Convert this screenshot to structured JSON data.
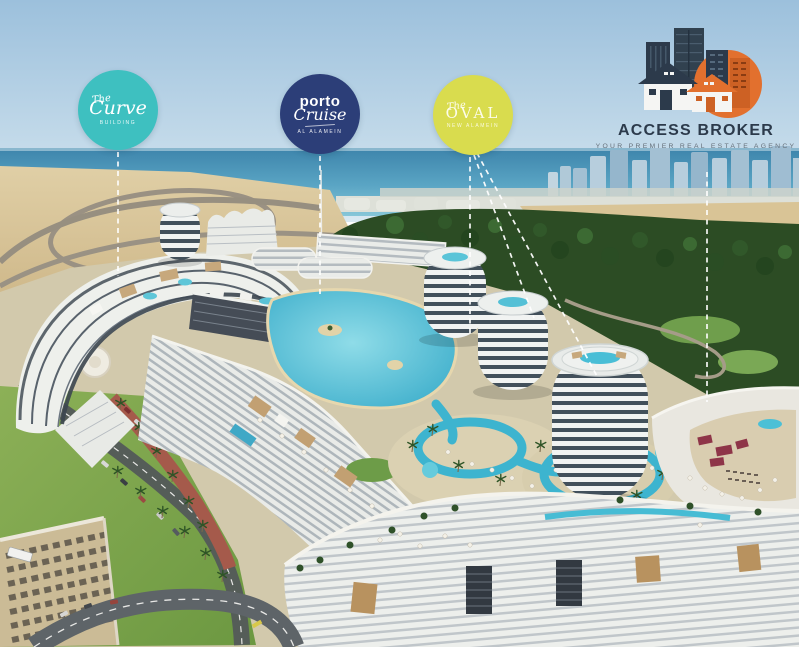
{
  "badges": {
    "curve": {
      "pre": "The",
      "name": "Curve",
      "sub": "BUILDING",
      "color": "#3ec0c0"
    },
    "porto": {
      "line1": "porto",
      "line2": "Cruise",
      "sub": "AL ALAMEIN",
      "color": "#2c3e78"
    },
    "oval": {
      "pre": "The",
      "name": "OVAL",
      "sub": "NEW ALAMEIN",
      "color": "#d9dc4e"
    }
  },
  "logo": {
    "title": "ACCESS BROKER",
    "tagline": "YOUR PREMIER REAL ESTATE AGENCY",
    "navy": "#2c3a4b",
    "orange": "#e2702e"
  },
  "scene_colors": {
    "sky": "#9cc0dc",
    "sea": "#4a90b5",
    "sand": "#d8c49a",
    "trees": "#2a4a22",
    "pool_water": "#3db4cf",
    "lawn": "#84aa50",
    "building_white": "#eef0ec",
    "promenade_red": "#a55a4b"
  }
}
